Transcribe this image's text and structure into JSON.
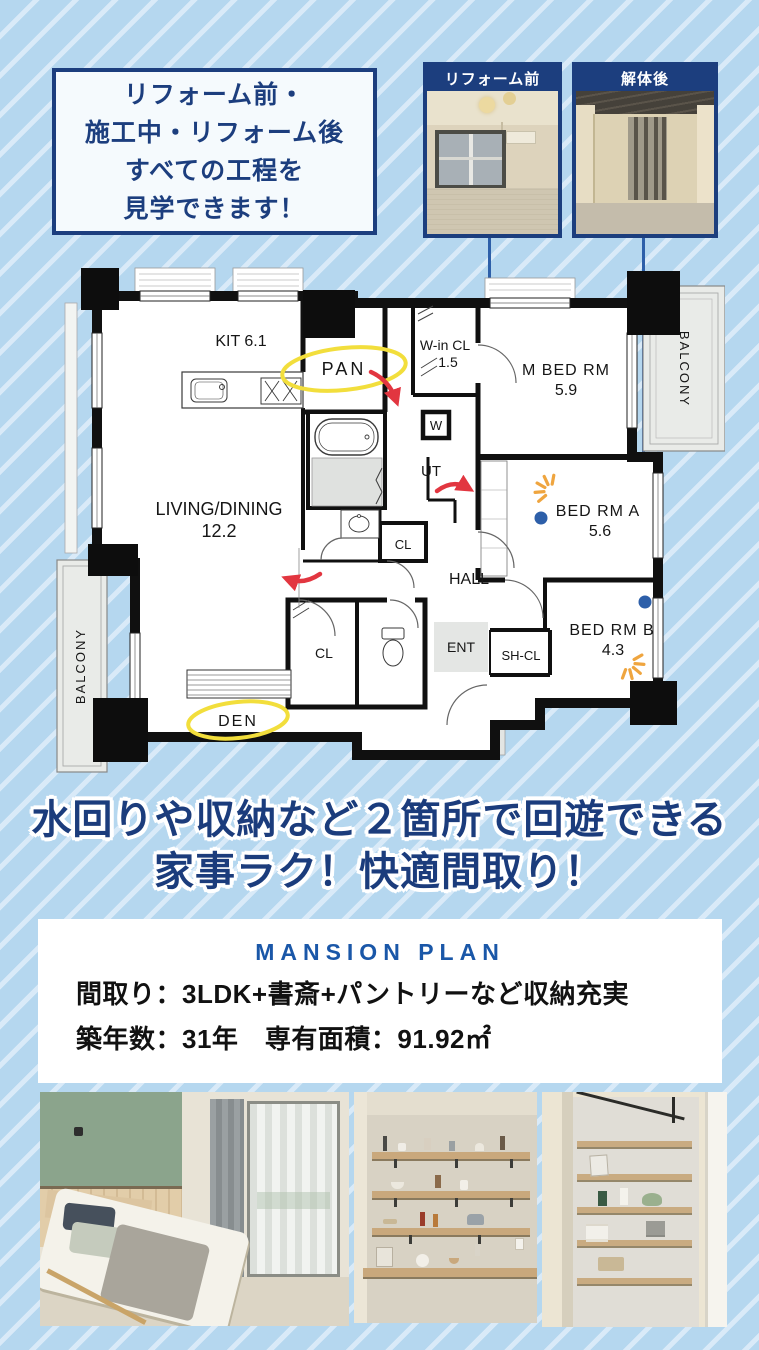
{
  "banner": {
    "lines": [
      "リフォーム前・",
      "施工中・リフォーム後",
      "すべての工程を",
      "見学できます！"
    ]
  },
  "top_photos": [
    {
      "label": "リフォーム前"
    },
    {
      "label": "解体後"
    }
  ],
  "floor_plan": {
    "rooms": {
      "kit": "KIT 6.1",
      "pan": "PAN",
      "win_cl": "W-in CL",
      "win_cl_size": "1.5",
      "m_bed": "M BED RM",
      "m_bed_size": "5.9",
      "living": "LIVING/DINING",
      "living_size": "12.2",
      "ut": "UT",
      "w": "W",
      "cl_mid": "CL",
      "hall": "HALL",
      "cl_low": "CL",
      "ent": "ENT",
      "sh_cl": "SH-CL",
      "bed_a": "BED RM A",
      "bed_a_size": "5.6",
      "bed_b": "BED RM B",
      "bed_b_size": "4.3",
      "den": "DEN",
      "balcony_left": "BALCONY",
      "balcony_right": "BALCONY"
    }
  },
  "headline": {
    "line1": "水回りや収納など２箇所で回遊できる",
    "line2": "家事ラク！快適間取り！"
  },
  "plan_card": {
    "title": "MANSION PLAN",
    "layout_line": "間取り：3LDK+書斎+パントリーなど収納充実",
    "age_area_line": "築年数：31年　専有面積：91.92㎡"
  },
  "bottom_photos": [
    {
      "name": "bedroom-photo"
    },
    {
      "name": "open-shelf-photo"
    },
    {
      "name": "pantry-shelf-photo"
    }
  ],
  "colors": {
    "background": "#b5d7ef",
    "stripe": "#d9eaf8",
    "navy": "#1c3e7e",
    "accent_blue": "#2d5fa9",
    "plan_title_blue": "#1a57a8",
    "highlight_yellow": "#f2de3c",
    "arrow_red": "#e23640",
    "sparkle_orange": "#efa53f"
  }
}
